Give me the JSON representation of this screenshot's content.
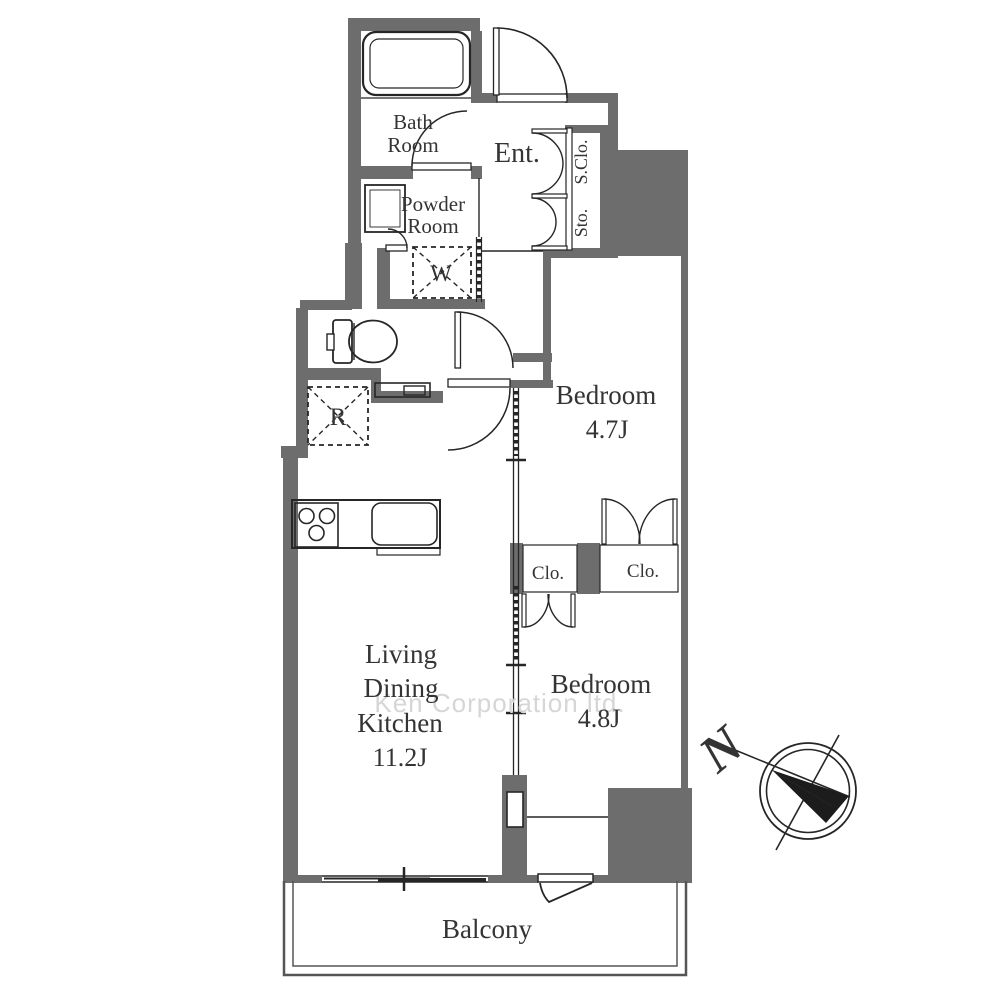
{
  "rooms": {
    "bath": {
      "line1": "Bath",
      "line2": "Room"
    },
    "powder": {
      "line1": "Powder",
      "line2": "Room"
    },
    "entrance": "Ent.",
    "shoe_closet": "S.Clo.",
    "storage": "Sto.",
    "bedroom1": {
      "name": "Bedroom",
      "size": "4.7J"
    },
    "bedroom2": {
      "name": "Bedroom",
      "size": "4.8J"
    },
    "ldk": {
      "line1": "Living",
      "line2": "Dining",
      "line3": "Kitchen",
      "size": "11.2J"
    },
    "closet_left": "Clo.",
    "closet_right": "Clo.",
    "balcony": "Balcony",
    "washer_mark": "W",
    "refrigerator_mark": "R"
  },
  "compass": {
    "north_label": "N"
  },
  "watermark": "Ken Corporation ltd.",
  "colors": {
    "wall": "#6d6d6d",
    "line": "#262626",
    "text": "#343434",
    "watermark": "#cfcfcf"
  }
}
